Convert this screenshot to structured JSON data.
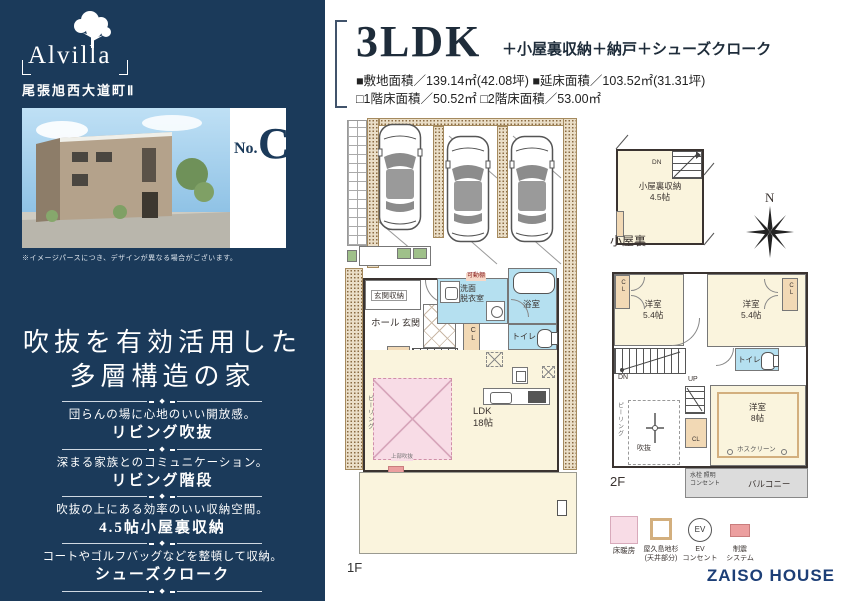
{
  "sidebar": {
    "logo": "Alvilla",
    "subtitle": "尾張旭西大道町Ⅱ",
    "unit_label": "No.",
    "unit_name": "C",
    "photo_caption": "※イメージパースにつき、デザインが異なる場合がございます。",
    "headline_line1": "吹抜を有効活用した",
    "headline_line2": "多層構造の家",
    "divider_glyph": "◆",
    "features": [
      {
        "desc": "団らんの場に心地のいい開放感。",
        "name": "リビング吹抜"
      },
      {
        "desc": "深まる家族とのコミュニケーション。",
        "name": "リビング階段"
      },
      {
        "desc": "吹抜の上にある効率のいい収納空間。",
        "name": "4.5帖小屋裏収納"
      },
      {
        "desc": "コートやゴルフバッグなどを整頓して収納。",
        "name": "シューズクローク"
      }
    ]
  },
  "header": {
    "plan_type": "3LDK",
    "plan_suffix": "＋小屋裏収納＋納戸＋シューズクローク",
    "area_line1": "■敷地面積／139.14㎡(42.08坪)  ■延床面積／103.52㎡(31.31坪)",
    "area_line2": "□1階床面積／50.52㎡ □2階床面積／53.00㎡"
  },
  "floor1": {
    "label": "1F",
    "entrance_storage": "玄関収納",
    "hall": "ホール",
    "entrance": "玄関",
    "scl": "SCL",
    "storage": "物入",
    "up": "UP",
    "washroom": "洗面\n脱衣室",
    "shelf": "可動棚",
    "bath": "浴室",
    "toilet": "トイレ",
    "ldk": "LDK\n18帖",
    "void_above": "上部吹抜",
    "peering": "ピーリング"
  },
  "attic": {
    "caption": "小屋裏",
    "room": "小屋裏収納\n4.5帖",
    "dn": "DN"
  },
  "compass_label": "N",
  "floor2": {
    "label": "2F",
    "bedroom1": "洋室\n5.4帖",
    "bedroom2": "洋室\n5.4帖",
    "bedroom3": "洋室\n8帖",
    "cl": "CL",
    "dn": "DN",
    "up": "UP",
    "toilet": "トイレ",
    "void": "吹抜",
    "peering": "ピーリング",
    "hoscreen": "ホスクリーン",
    "balcony": "バルコニー",
    "balcony_note": "水栓 照明\nコンセント"
  },
  "legend": {
    "ev_glyph": "EV",
    "items": [
      {
        "label": "床暖房"
      },
      {
        "label": "屋久島地杉\n(天井部分)"
      },
      {
        "label": "EV\nコンセント"
      },
      {
        "label": "制震\nシステム"
      }
    ]
  },
  "brand": "ZAISO HOUSE",
  "colors": {
    "navy": "#1b3a5a",
    "cream": "#faf4dd",
    "wet_blue": "#b5e0f0",
    "heating_pink": "#f8dce6",
    "wood_tan": "#f2d9b5",
    "damper_pink": "#ec9f9f",
    "brand_navy": "#1d3f77"
  }
}
